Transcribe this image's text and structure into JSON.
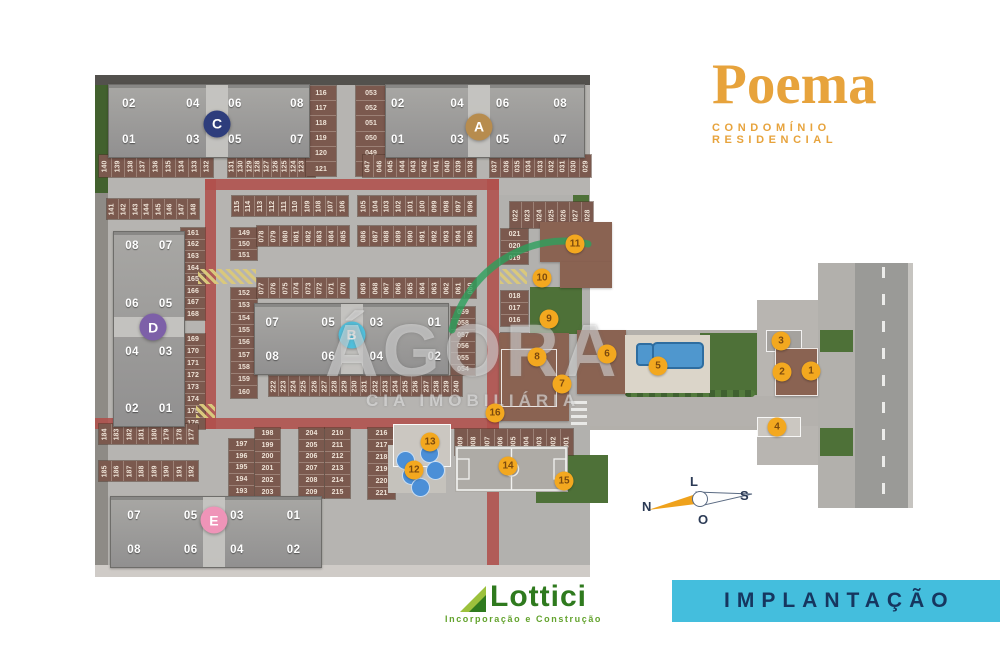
{
  "brand": {
    "title": "Poema",
    "subtitle": "CONDOMÍNIO RESIDENCIAL",
    "accent": "#E7A33C"
  },
  "plan_label": {
    "text": "IMPLANTAÇÃO",
    "bg": "#44BEDD",
    "text_color": "#16365F"
  },
  "developer": {
    "name": "Lottici",
    "tagline": "Incorporação e Construção",
    "color": "#2F7A1E"
  },
  "watermark": {
    "line1": "ÁGORA",
    "line2": "CIA IMOBILIÁRIA"
  },
  "compass": {
    "north": "N",
    "south": "S",
    "east": "L",
    "west": "O"
  },
  "site": {
    "towers": [
      {
        "letter": "C",
        "badge_color": "#2e3d7c",
        "x": 108,
        "y": 84,
        "w": 200,
        "h": 72,
        "o": "h",
        "top": [
          "02",
          "04",
          "06",
          "08"
        ],
        "bottom": [
          "01",
          "03",
          "05",
          "07"
        ],
        "fx": [
          10,
          42,
          63,
          94
        ],
        "bx": 54,
        "by": 54
      },
      {
        "letter": "A",
        "badge_color": "#b78c4e",
        "x": 385,
        "y": 84,
        "w": 198,
        "h": 72,
        "o": "h",
        "top": [
          "02",
          "04",
          "06",
          "08"
        ],
        "bottom": [
          "01",
          "03",
          "05",
          "07"
        ],
        "fx": [
          6,
          36,
          59,
          88
        ],
        "bx": 47,
        "by": 58
      },
      {
        "letter": "D",
        "badge_color": "#7d60a8",
        "x": 113,
        "y": 231,
        "w": 70,
        "h": 194,
        "o": "v",
        "rows": [
          [
            "08",
            "07"
          ],
          [
            "06",
            "05"
          ],
          [
            "04",
            "03"
          ],
          [
            "02",
            "01"
          ]
        ],
        "fy": [
          7,
          37,
          62,
          91
        ],
        "fx2": [
          26,
          74
        ],
        "bx": 56,
        "by": 49
      },
      {
        "letter": "B",
        "badge_color": "#4fc0dd",
        "x": 254,
        "y": 303,
        "w": 193,
        "h": 70,
        "o": "h",
        "top": [
          "07",
          "05",
          "03",
          "01"
        ],
        "bottom": [
          "08",
          "06",
          "04",
          "02"
        ],
        "fx": [
          9,
          38,
          63,
          93
        ],
        "bx": 50,
        "by": 44
      },
      {
        "letter": "E",
        "badge_color": "#ef94b8",
        "x": 110,
        "y": 496,
        "w": 210,
        "h": 70,
        "o": "h",
        "top": [
          "07",
          "05",
          "03",
          "01"
        ],
        "bottom": [
          "08",
          "06",
          "04",
          "02"
        ],
        "fx": [
          11,
          38,
          60,
          87
        ],
        "bx": 49,
        "by": 33
      }
    ],
    "markers": [
      {
        "n": "1",
        "x": 811,
        "y": 371
      },
      {
        "n": "2",
        "x": 782,
        "y": 372
      },
      {
        "n": "3",
        "x": 781,
        "y": 341
      },
      {
        "n": "4",
        "x": 777,
        "y": 427
      },
      {
        "n": "5",
        "x": 658,
        "y": 366
      },
      {
        "n": "6",
        "x": 607,
        "y": 354
      },
      {
        "n": "7",
        "x": 562,
        "y": 384
      },
      {
        "n": "8",
        "x": 537,
        "y": 357
      },
      {
        "n": "9",
        "x": 549,
        "y": 319
      },
      {
        "n": "10",
        "x": 542,
        "y": 278
      },
      {
        "n": "11",
        "x": 575,
        "y": 244
      },
      {
        "n": "12",
        "x": 414,
        "y": 470
      },
      {
        "n": "13",
        "x": 430,
        "y": 442
      },
      {
        "n": "14",
        "x": 508,
        "y": 466
      },
      {
        "n": "15",
        "x": 564,
        "y": 481
      },
      {
        "n": "16",
        "x": 495,
        "y": 413
      }
    ],
    "parking": [
      {
        "nums": [
          "140",
          "139",
          "138",
          "137",
          "136",
          "135",
          "134",
          "133",
          "132"
        ],
        "x": 99,
        "y": 155,
        "dir": "h",
        "ch": 22,
        "cw": 11.8
      },
      {
        "nums": [
          "131",
          "130",
          "129",
          "128",
          "127",
          "126",
          "125",
          "124",
          "123",
          "122"
        ],
        "x": 228,
        "y": 155,
        "dir": "h",
        "ch": 22,
        "cw": 7.8
      },
      {
        "nums": [
          "116",
          "117",
          "118",
          "119",
          "120",
          "121"
        ],
        "x": 306,
        "y": 86,
        "dir": "v",
        "w": 30,
        "ch": 14.2
      },
      {
        "nums": [
          "053",
          "052",
          "051",
          "050",
          "049",
          "048"
        ],
        "x": 356,
        "y": 86,
        "dir": "v",
        "w": 30,
        "ch": 14.2
      },
      {
        "nums": [
          "047",
          "046",
          "045",
          "044",
          "043",
          "042",
          "041",
          "040",
          "039",
          "038"
        ],
        "x": 363,
        "y": 155,
        "dir": "h",
        "ch": 22,
        "cw": 10.4
      },
      {
        "nums": [
          "037",
          "036",
          "035",
          "034",
          "033",
          "032",
          "031",
          "030",
          "029"
        ],
        "x": 490,
        "y": 155,
        "dir": "h",
        "ch": 22,
        "cw": 10.3
      },
      {
        "nums": [
          "141",
          "142",
          "143",
          "144",
          "145",
          "146",
          "147",
          "148"
        ],
        "x": 107,
        "y": 199,
        "dir": "h",
        "ch": 20,
        "cw": 10.6
      },
      {
        "nums": [
          "115",
          "114",
          "113",
          "112",
          "111",
          "110",
          "109",
          "108",
          "107",
          "106"
        ],
        "x": 232,
        "y": 196,
        "dir": "h",
        "ch": 20,
        "cw": 10.7
      },
      {
        "nums": [
          "105",
          "104",
          "103",
          "102",
          "101",
          "100",
          "099",
          "098",
          "097",
          "096"
        ],
        "x": 358,
        "y": 196,
        "dir": "h",
        "ch": 20,
        "cw": 10.9
      },
      {
        "nums": [
          "149",
          "150",
          "151"
        ],
        "x": 231,
        "y": 228,
        "dir": "v",
        "w": 26,
        "ch": 10
      },
      {
        "nums": [
          "078",
          "079",
          "080",
          "081",
          "082",
          "083",
          "084",
          "085"
        ],
        "x": 257,
        "y": 226,
        "dir": "h",
        "ch": 20,
        "cw": 10.6
      },
      {
        "nums": [
          "086",
          "087",
          "088",
          "089",
          "090",
          "091",
          "092",
          "093",
          "094",
          "095"
        ],
        "x": 358,
        "y": 226,
        "dir": "h",
        "ch": 20,
        "cw": 10.9
      },
      {
        "nums": [
          "161",
          "162",
          "163",
          "164",
          "165",
          "166",
          "167",
          "168"
        ],
        "x": 181,
        "y": 228,
        "dir": "v",
        "w": 24,
        "ch": 10.6
      },
      {
        "nums": [
          "152",
          "153",
          "154",
          "155",
          "156",
          "157",
          "158",
          "159",
          "160"
        ],
        "x": 231,
        "y": 288,
        "dir": "v",
        "w": 26,
        "ch": 11.3
      },
      {
        "nums": [
          "077",
          "076",
          "075",
          "074",
          "073",
          "072",
          "071",
          "070"
        ],
        "x": 257,
        "y": 278,
        "dir": "h",
        "ch": 20,
        "cw": 10.6
      },
      {
        "nums": [
          "069",
          "068",
          "067",
          "066",
          "065",
          "064",
          "063",
          "062",
          "061",
          "060"
        ],
        "x": 358,
        "y": 278,
        "dir": "h",
        "ch": 20,
        "cw": 10.9
      },
      {
        "nums": [
          "169",
          "170",
          "171",
          "172",
          "173",
          "174",
          "175",
          "176"
        ],
        "x": 181,
        "y": 334,
        "dir": "v",
        "w": 24,
        "ch": 11
      },
      {
        "nums": [
          "059",
          "058",
          "057",
          "056",
          "055",
          "054"
        ],
        "x": 451,
        "y": 307,
        "dir": "v",
        "w": 24,
        "ch": 10.5
      },
      {
        "nums": [
          "022",
          "023",
          "024",
          "025",
          "026",
          "027",
          "028"
        ],
        "x": 510,
        "y": 202,
        "dir": "h",
        "ch": 26,
        "cw": 11
      },
      {
        "nums": [
          "021",
          "020",
          "019"
        ],
        "x": 501,
        "y": 229,
        "dir": "v",
        "w": 27,
        "ch": 11
      },
      {
        "nums": [
          "018",
          "017",
          "016"
        ],
        "x": 501,
        "y": 291,
        "dir": "v",
        "w": 27,
        "ch": 11
      },
      {
        "nums": [
          "015",
          "014",
          "013",
          "012",
          "011",
          "010"
        ],
        "x": 501,
        "y": 333,
        "dir": "v",
        "w": 27,
        "ch": 10.7
      },
      {
        "nums": [
          "222",
          "223",
          "224",
          "225",
          "226",
          "227",
          "228",
          "229",
          "230",
          "231",
          "232",
          "233",
          "234",
          "235",
          "236",
          "237",
          "238",
          "239",
          "240"
        ],
        "x": 269,
        "y": 376,
        "dir": "h",
        "ch": 20,
        "cw": 9.2
      },
      {
        "nums": [
          "184",
          "183",
          "182",
          "181",
          "180",
          "179",
          "178",
          "177"
        ],
        "x": 99,
        "y": 424,
        "dir": "h",
        "ch": 20,
        "cw": 11.5
      },
      {
        "nums": [
          "185",
          "186",
          "187",
          "188",
          "189",
          "190",
          "191",
          "192"
        ],
        "x": 99,
        "y": 461,
        "dir": "h",
        "ch": 20,
        "cw": 11.5
      },
      {
        "nums": [
          "197",
          "196",
          "195",
          "194",
          "193"
        ],
        "x": 229,
        "y": 439,
        "dir": "v",
        "w": 25,
        "ch": 10.8
      },
      {
        "nums": [
          "198",
          "199",
          "200",
          "201",
          "202",
          "203"
        ],
        "x": 255,
        "y": 428,
        "dir": "v",
        "w": 25,
        "ch": 10.8
      },
      {
        "nums": [
          "204",
          "205",
          "206",
          "207",
          "208",
          "209"
        ],
        "x": 299,
        "y": 428,
        "dir": "v",
        "w": 25,
        "ch": 10.8
      },
      {
        "nums": [
          "210",
          "211",
          "212",
          "213",
          "214",
          "215"
        ],
        "x": 325,
        "y": 428,
        "dir": "v",
        "w": 25,
        "ch": 10.8
      },
      {
        "nums": [
          "216",
          "217",
          "218",
          "219",
          "220",
          "221"
        ],
        "x": 368,
        "y": 428,
        "dir": "v",
        "w": 27,
        "ch": 11
      },
      {
        "nums": [
          "009",
          "008",
          "007",
          "006",
          "005",
          "004",
          "003",
          "002",
          "001"
        ],
        "x": 455,
        "y": 429,
        "dir": "h",
        "ch": 26,
        "cw": 12.2
      }
    ]
  }
}
